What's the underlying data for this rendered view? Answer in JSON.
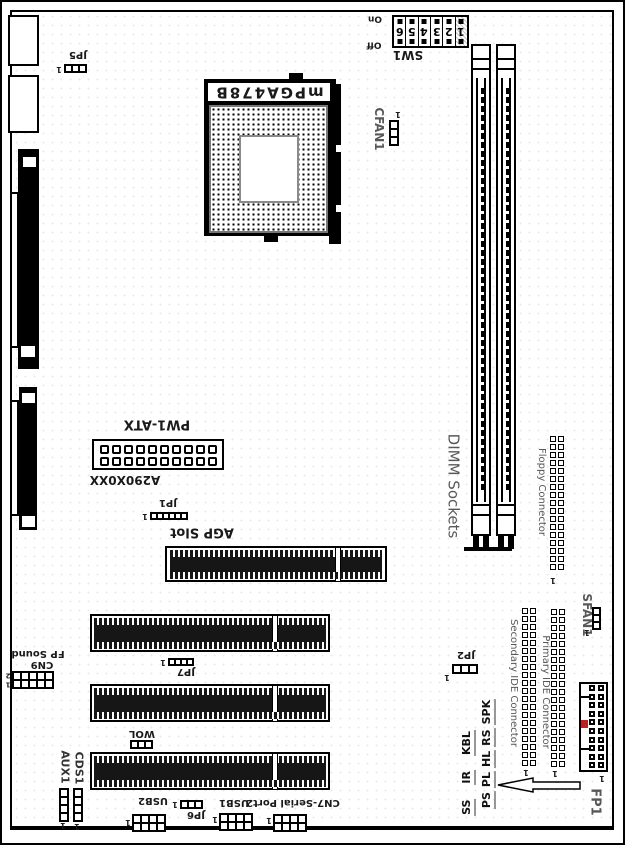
{
  "colors": {
    "line": "#000000",
    "gray_label": "#585858",
    "slot_fill": "#161616",
    "fp1_key": "#bb2222"
  },
  "labels": {
    "jp5": "JP5",
    "cpu": "mPGA478B",
    "cfan1": "CFAN1",
    "dimm": "DIMM Sockets",
    "floppy": "Floppy Connector",
    "sfan1": "SFAN1",
    "jp2": "JP2",
    "sec_ide": "Secondary IDE Connector",
    "pri_ide": "Primary IDE Connector",
    "pw1": "PW1-ATX",
    "part": "A290X0XX",
    "jp1": "JP1",
    "agp": "AGP Slot",
    "jp7": "JP7",
    "wol": "WOL",
    "usb2": "USB2",
    "jp6": "JP6",
    "usb1": "USB1",
    "cn7": "CN7-Serial Port2",
    "cn9": "CN9",
    "fp_sound": "FP Sound",
    "aux1": "AUX1",
    "cds1": "CDS1"
  },
  "sw1": {
    "name": "SW1",
    "on": "On",
    "off": "Off",
    "digits": [
      "6",
      "5",
      "4",
      "3",
      "2",
      "1"
    ]
  },
  "fp1": {
    "name": "FP1",
    "col1": [
      "SS",
      "IR",
      "KBL"
    ],
    "col2": [
      "PS",
      "PL",
      "HL",
      "RS",
      "SPK"
    ]
  },
  "markers": {
    "p1": "1",
    "p2": "2"
  }
}
